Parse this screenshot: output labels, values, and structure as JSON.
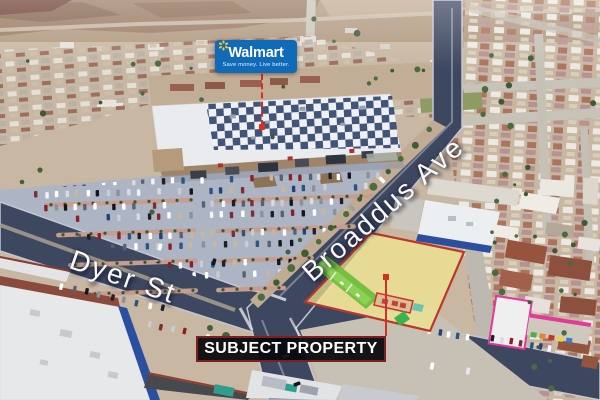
{
  "walmart_sign": {
    "brand": "Walmart",
    "tagline": "Save money. Live better."
  },
  "street_labels": {
    "dyer": "Dyer St",
    "broaddus": "Broaddus Ave"
  },
  "property_label": "SUBJECT PROPERTY",
  "colors": {
    "walmart_blue": "#0f6bb7",
    "walmart_spark_yellow": "#ffc220",
    "leader_line_red": "#d7281f",
    "parcel_highlight_yellow": "#f2e88f",
    "parcel_outline_red": "#bf3527",
    "label_box_black": "#0b0b10",
    "label_border_red": "#7e1f1f"
  }
}
